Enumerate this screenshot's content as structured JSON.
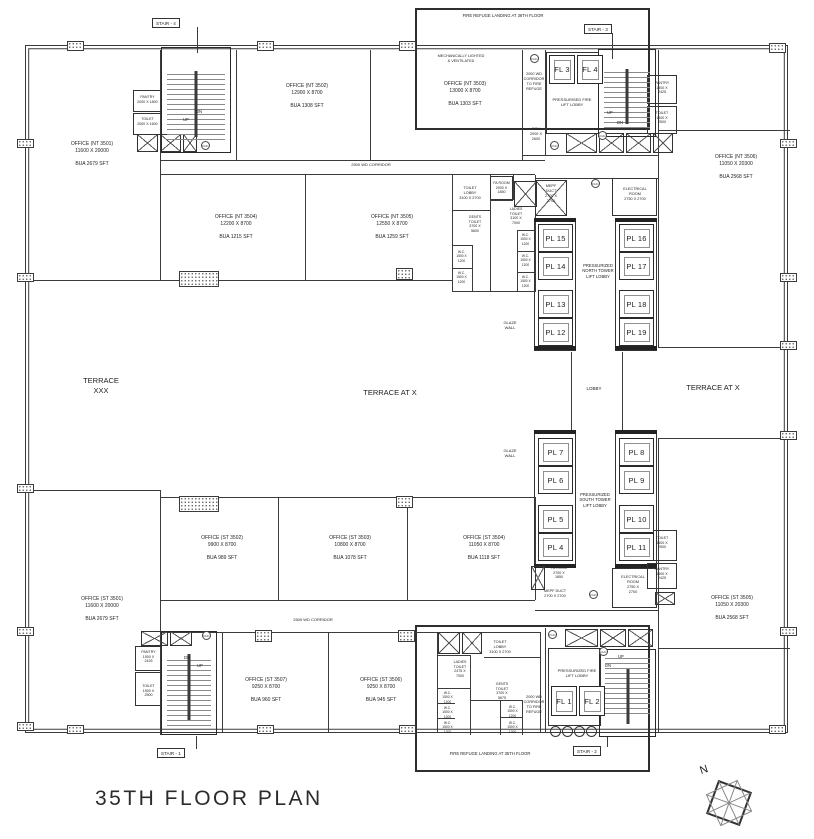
{
  "title": "35TH FLOOR PLAN",
  "compass_n": "N",
  "refuge": {
    "top": "FIRE REFUGE LANDING AT 36TH FLOOR",
    "bottom": "FIRE REFUGE LANDING AT 35TH FLOOR"
  },
  "corridors": {
    "top": "2500 WD CORRIDOR",
    "bottom": "2500 WD CORRIDOR",
    "to_refuge": "2000 WD\nCORRIDOR\nTO FIRE\nREFUGE",
    "ech": "ECH\n2000 X\n2600"
  },
  "stairs": {
    "s1": "STAIR - 1",
    "s2": "STAIR - 2",
    "s3": "STAIR - 3",
    "s4": "STAIR - 4",
    "up": "UP",
    "dn": "DN"
  },
  "offices": {
    "nt3501": "OFFICE (NT 3501)\n11600 X 20000\n\nBUA 2679 SFT",
    "nt3502": "OFFICE (NT 3502)\n12900 X 8700\n\nBUA 1308 SFT",
    "nt3503": "OFFICE (NT 3503)\n13000 X 8700\n\nBUA 1303 SFT",
    "mech_note": "MECHANICALLY LIGHTED\n& VENTILATED",
    "nt3504": "OFFICE (NT 3504)\n12200 X 8700\n\nBUA 1215 SFT",
    "nt3505": "OFFICE (NT 3505)\n12550 X 8700\n\nBUA 1259 SFT",
    "nt3506": "OFFICE (NT 3506)\n11050 X 20300\n\nBUA 2568 SFT",
    "st3501": "OFFICE (ST 3501)\n11600 X 20000\n\nBUA 2679 SFT",
    "st3502": "OFFICE (ST 3502)\n9900 X 8700\n\nBUA 989 SFT",
    "st3503": "OFFICE (ST 3503)\n10800 X 8700\n\nBUA 1078 SFT",
    "st3504": "OFFICE (ST 3504)\n11050 X 8700\n\nBUA 1118 SFT",
    "st3505": "OFFICE (ST 3505)\n11050 X 20300\n\nBUA 2568 SFT",
    "st3506": "OFFICE (ST 3506)\n9250 X 8700\n\nBUA 945 SFT",
    "st3507": "OFFICE (ST 3507)\n9250 X 8700\n\nBUA 960 SFT"
  },
  "terraces": {
    "left": "TERRACE\nXXX",
    "center": "TERRACE AT X",
    "right": "TERRACE AT X"
  },
  "lobbies": {
    "north": "PRESSURIZED\nNORTH TOWER\nLIFT LOBBY",
    "south": "PRESSURIZED\nSOUTH TOWER\nLIFT LOBBY",
    "fire_top": "PRESSURISED FIRE\nLIFT LOBBY",
    "fire_bottom": "PRESSURIZED FIRE\nLIFT LOBBY",
    "lobby": "LOBBY",
    "glaze": "GLAZE\nWALL"
  },
  "lifts": {
    "fl1": "FL 1",
    "fl2": "FL 2",
    "fl3": "FL 3",
    "fl4": "FL 4",
    "pl4": "PL 4",
    "pl5": "PL 5",
    "pl6": "PL 6",
    "pl7": "PL 7",
    "pl8": "PL 8",
    "pl9": "PL 9",
    "pl10": "PL 10",
    "pl11": "PL 11",
    "pl12": "PL 12",
    "pl13": "PL 13",
    "pl14": "PL 14",
    "pl15": "PL 15",
    "pl16": "PL 16",
    "pl17": "PL 17",
    "pl18": "PL 18",
    "pl19": "PL 19"
  },
  "rooms": {
    "mepf_n": "MEPF\nDUCT\n2700 X\n2700",
    "mepf_s": "MEPF DUCT\n2700 X 2700",
    "elec_n": "ELECTRICAL\nROOM\n2750 X 2700",
    "elec_s": "ELECTRICAL\nROOM\n2750 X\n2700",
    "fa_n": "FA ROOM\n2000 X\n1850",
    "fa_s": "FA ROOM\n2700 X\n1850",
    "toilet_lobby_n": "TOILET\nLOBBY\n3100 X 2700",
    "toilet_lobby_s": "TOILET\nLOBBY\n3100 X 2700",
    "gents_n": "GENTS\nTOILET\n3700 X\n5600",
    "gents_s": "GENTS\nTOILET\n3700 X\n5675",
    "ladies_n": "LADIES\nTOILET\n3100 X\n7000",
    "ladies_s": "LADIES\nTOILET\n2475 X\n7000",
    "wc": "W.C.\n1500 X\n1200",
    "pantry_nw": "PANTRY\n2000 X 1800",
    "toilet_nw": "TOILET\n2000 X 1600",
    "pantry_ne": "PANTRY\n1500 X\n2425",
    "toilet_ne": "TOILET\n1500 X\n2500",
    "toilet_se": "TOILET\n1500 X\n2500",
    "pantry_se": "PANTRY\n1500 X\n2425",
    "pantry_sw": "PANTRY\n1500 X\n2425",
    "toilet_sw": "TOILET\n1500 X\n2500",
    "fhc": "FHC"
  }
}
